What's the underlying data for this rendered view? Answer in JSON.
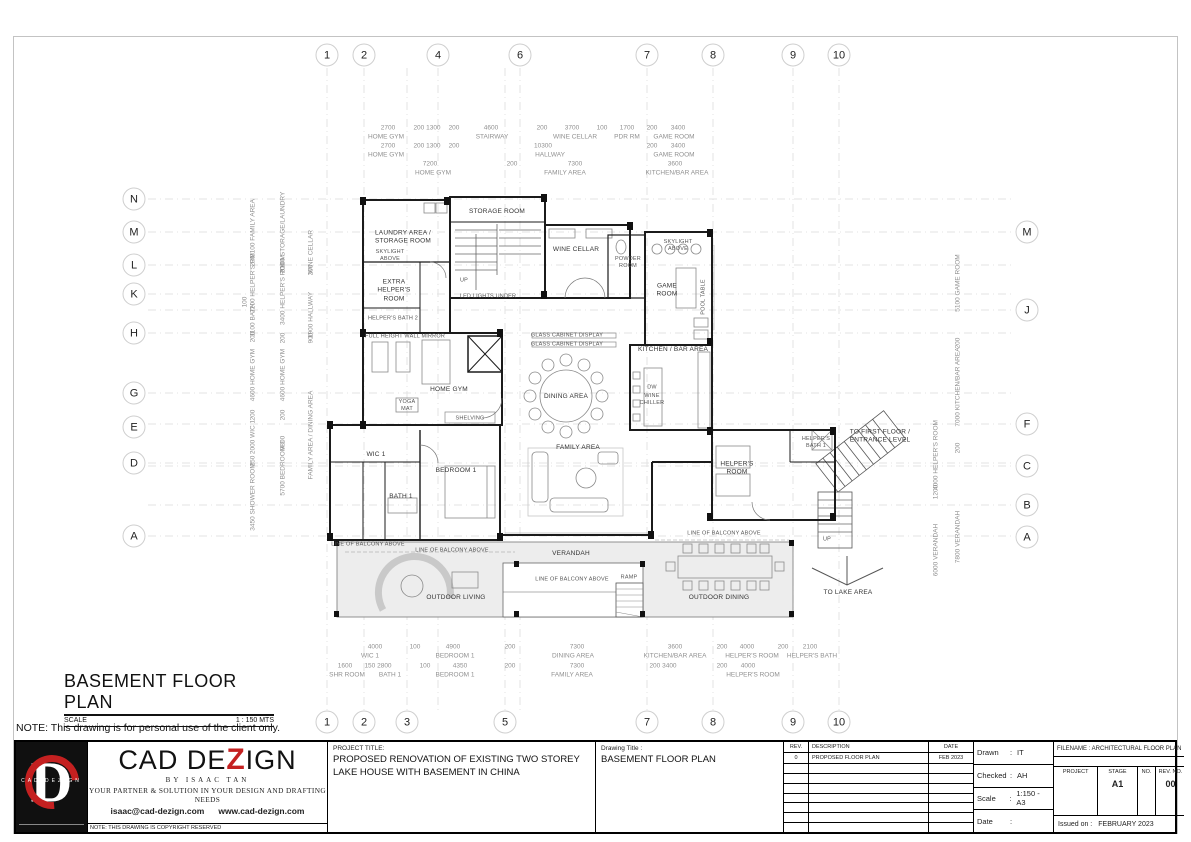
{
  "heading": {
    "title": "BASEMENT FLOOR PLAN",
    "scale_label": "SCALE",
    "scale_value": "1 : 150 MTS",
    "note": "NOTE: This drawing is for personal use of the client only."
  },
  "grid": {
    "top": [
      "1",
      "2",
      "4",
      "6",
      "7",
      "8",
      "9",
      "10"
    ],
    "bottom": [
      "1",
      "2",
      "3",
      "5",
      "7",
      "8",
      "9",
      "10"
    ],
    "left": [
      "N",
      "M",
      "L",
      "K",
      "H",
      "G",
      "E",
      "D",
      "A"
    ],
    "right": [
      "M",
      "J",
      "F",
      "C",
      "B",
      "A"
    ]
  },
  "rooms": [
    "STORAGE ROOM",
    "LAUNDRY AREA /\nSTORAGE ROOM",
    "SKYLIGHT\nABOVE",
    "EXTRA\nHELPER'S\nROOM",
    "HELPER'S BATH 2",
    "UP",
    "LED LIGHTS UNDER",
    "WINE CELLAR",
    "POWDER\nROOM",
    "SKYLIGHT\nABOVE",
    "GAME\nROOM",
    "FULL HEIGHT WALL MIRROR",
    "GLASS CABINET DISPLAY",
    "GLASS CABINET DISPLAY",
    "HOME GYM",
    "YOGA\nMAT",
    "SHELVING",
    "KITCHEN / BAR AREA",
    "DW",
    "WINE\nCHILLER",
    "DINING AREA",
    "FAMILY AREA",
    "WIC 1",
    "BATH 1",
    "BEDROOM 1",
    "POOL TABLE",
    "HELPER'S\nROOM",
    "HELPER'S\nBATH 1",
    "TO FIRST FLOOR /\nENTRANCE LEVEL",
    "LINE OF BALCONY ABOVE",
    "LINE OF BALCONY ABOVE",
    "VERANDAH",
    "LINE OF BALCONY ABOVE",
    "RAMP",
    "LINE OF BALCONY ABOVE",
    "OUTDOOR LIVING",
    "OUTDOOR DINING",
    "UP",
    "TO LAKE AREA"
  ],
  "dims": {
    "t0": [
      "2700",
      "200 1300",
      "200",
      "4600",
      "200",
      "3700",
      "100",
      "1700",
      "200",
      "3400"
    ],
    "t1": [
      "HOME GYM",
      "STAIRWAY",
      "WINE CELLAR",
      "PDR RM",
      "GAME ROOM"
    ],
    "t2": [
      "2700",
      "200 1300",
      "200",
      "10300",
      "200",
      "3400"
    ],
    "t3": [
      "HOME GYM",
      "HALLWAY",
      "GAME ROOM"
    ],
    "t4": [
      "7200",
      "200",
      "7300",
      "3600"
    ],
    "t5": [
      "HOME GYM",
      "FAMILY AREA",
      "KITCHEN/BAR AREA"
    ],
    "b0": [
      "4000",
      "100",
      "4900",
      "200",
      "7300",
      "3600",
      "200",
      "4000",
      "200",
      "2100"
    ],
    "b1": [
      "WIC 1",
      "BEDROOM 1",
      "DINING AREA",
      "KITCHEN/BAR AREA",
      "HELPER'S ROOM",
      "HELPER'S BATH"
    ],
    "b2": [
      "1600",
      "150 2800",
      "100",
      "4350",
      "200",
      "7300",
      "200 3400",
      "200",
      "4000"
    ],
    "b3": [
      "SHR ROOM",
      "BATH 1",
      "BEDROOM 1",
      "FAMILY AREA",
      "HELPER'S ROOM"
    ],
    "l0": [
      "3100 FAMILY AREA",
      "200",
      "2200 HELPER'S RM",
      "100",
      "1100 BATH",
      "200",
      "4600 HOME GYM",
      "200",
      "2000 WIC 1",
      "250",
      "3450 SHOWER ROOM"
    ],
    "l1": [
      "3100 STORAGE/LAUNDRY",
      "200",
      "3400 HELPER'S ROOM",
      "200",
      "4600 HOME GYM",
      "200",
      "9800",
      "5700 BEDROOM 1"
    ],
    "l2": [
      "WINE CELLAR",
      "200",
      "1900 HALLWAY",
      "900",
      "FAMILY AREA / DINING AREA"
    ],
    "r0": [
      "4000 HELPER'S ROOM",
      "1200",
      "6000 VERANDAH"
    ],
    "r1": [
      "5100 GAME ROOM",
      "200",
      "7000 KITCHEN/BAR AREA",
      "200",
      "7800 VERANDAH"
    ]
  },
  "titleblock": {
    "logo_d": "D",
    "logo_text": "CAD DEZIGN",
    "brand_pre": "CAD DE",
    "brand_z": "Z",
    "brand_post": "IGN",
    "byline": "BY ISAAC TAN",
    "tagline": "YOUR PARTNER & SOLUTION IN YOUR DESIGN AND DRAFTING NEEDS",
    "email": "isaac@cad-dezign.com",
    "website": "www.cad-dezign.com",
    "copyright": "NOTE: THIS DRAWING IS COPYRIGHT RESERVED",
    "project_label": "PROJECT TITLE:",
    "project_title": "PROPOSED RENOVATION OF EXISTING TWO STOREY LAKE HOUSE WITH BASEMENT IN CHINA",
    "drawing_label": "Drawing Title :",
    "drawing_title": "BASEMENT FLOOR PLAN",
    "rev_headers": [
      "REV.",
      "DESCRIPTION",
      "DATE"
    ],
    "rev_row": [
      "0",
      "PROPOSED FLOOR PLAN",
      "FEB 2023"
    ],
    "colon": ":",
    "meta": [
      {
        "l": "Drawn",
        "v": "IT"
      },
      {
        "l": "Checked",
        "v": "AH"
      },
      {
        "l": "Scale",
        "v": "1:150 - A3"
      },
      {
        "l": "Date",
        "v": ""
      }
    ],
    "filename": "FILENAME :  ARCHITECTURAL FLOOR PLAN",
    "cols": [
      "PROJECT",
      "STAGE",
      "NO.",
      "REV. NO."
    ],
    "stage": "A1",
    "no": "",
    "rev_no": "00",
    "issued_label": "Issued on :",
    "issued": "FEBRUARY 2023"
  }
}
